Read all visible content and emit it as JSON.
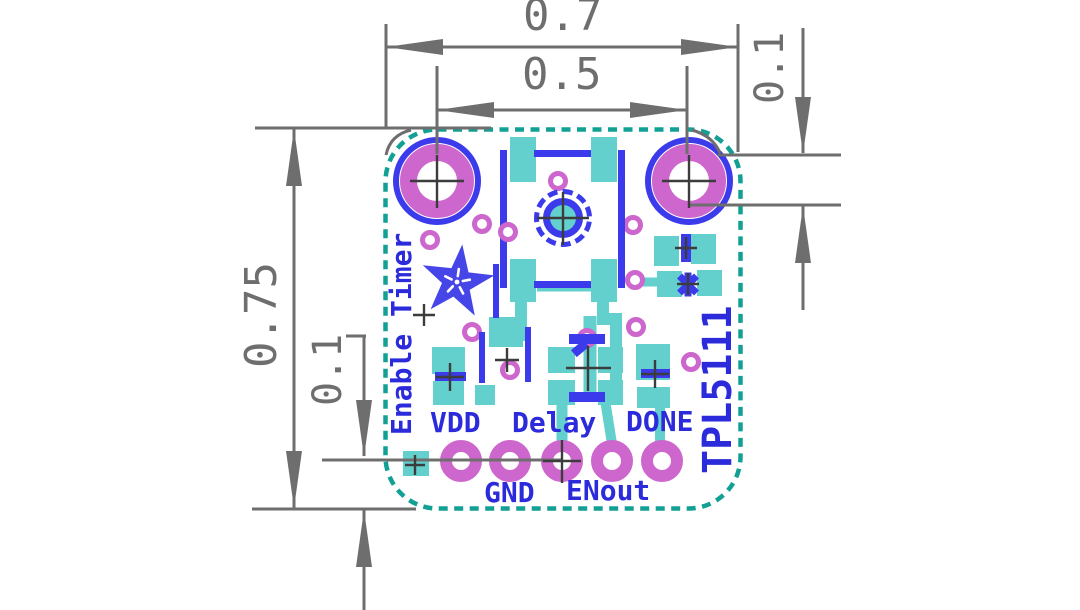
{
  "drawing": {
    "dimensions": {
      "board_width": "0.7",
      "hole_spacing": "0.5",
      "board_height": "0.75",
      "pad_row_inset": "0.1",
      "hole_inset": "0.1"
    },
    "silkscreen": {
      "enable_label": "Enable Timer",
      "chip_label": "TPL5111",
      "pins": {
        "vdd": "VDD",
        "gnd": "GND",
        "delay": "Delay",
        "enout": "ENout",
        "done": "DONE"
      }
    },
    "icons": {
      "logo": "adafruit-flower-logo"
    },
    "colors": {
      "silkscreen_blue": "#2b2bdc",
      "pad_teal": "#63d0cd",
      "drill_magenta": "#cd66cd",
      "board_outline_teal": "#12a094",
      "dimension_gray": "#6e6e6e"
    }
  }
}
